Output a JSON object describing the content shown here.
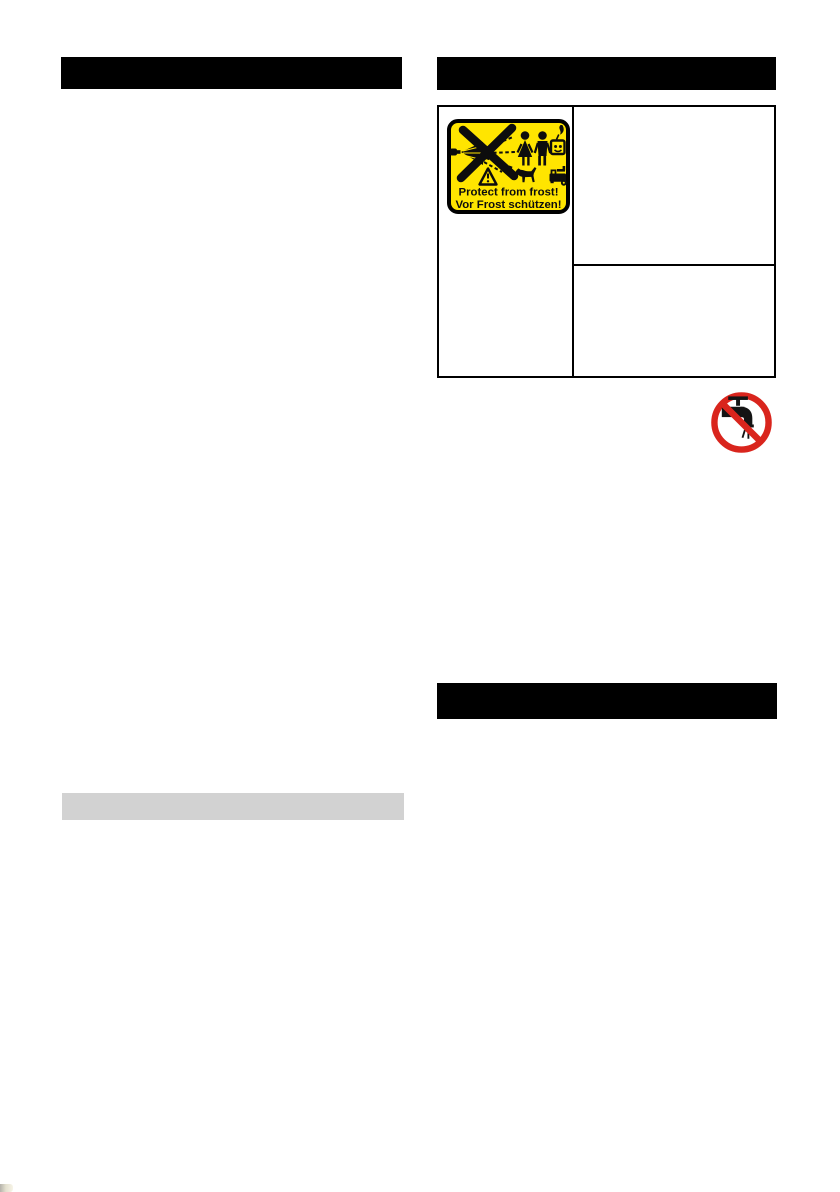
{
  "document": {
    "type": "operating-manual-page",
    "background": "#ffffff"
  },
  "left_column": {
    "section_header_bar": {
      "text": "",
      "background": "#000000"
    },
    "subsection_bar": {
      "text": "",
      "background": "#d2d2d2"
    }
  },
  "right_column": {
    "section_header_bar": {
      "text": "",
      "background": "#000000"
    },
    "lower_section_header_bar": {
      "text": "",
      "background": "#000000"
    },
    "table": {
      "border_color": "#000000",
      "left_cell_content": "frost-warning-sticker",
      "right_top_cell_text": "",
      "right_bottom_cell_text": ""
    },
    "no_tap_water_icon": {
      "meaning": "do-not-connect-to-drinking-water-tap",
      "ring_color": "#d9251d",
      "symbol_color": "#141414"
    }
  },
  "sticker": {
    "background_color": "#ffe500",
    "border_color": "#000000",
    "text_color": "#0d0d0d",
    "text_line1": "Protect from frost!",
    "text_line2": "Vor Frost schützen!",
    "pictograms": [
      "spray-lance-icon",
      "cross-out-x-icon",
      "spray-jet-dashes-icon",
      "woman-icon",
      "man-icon",
      "socket-flame-icon",
      "warning-triangle-icon",
      "dog-icon",
      "pressure-washer-icon"
    ]
  },
  "page_artifact": {
    "note": "small print smudge bottom-left corner"
  }
}
